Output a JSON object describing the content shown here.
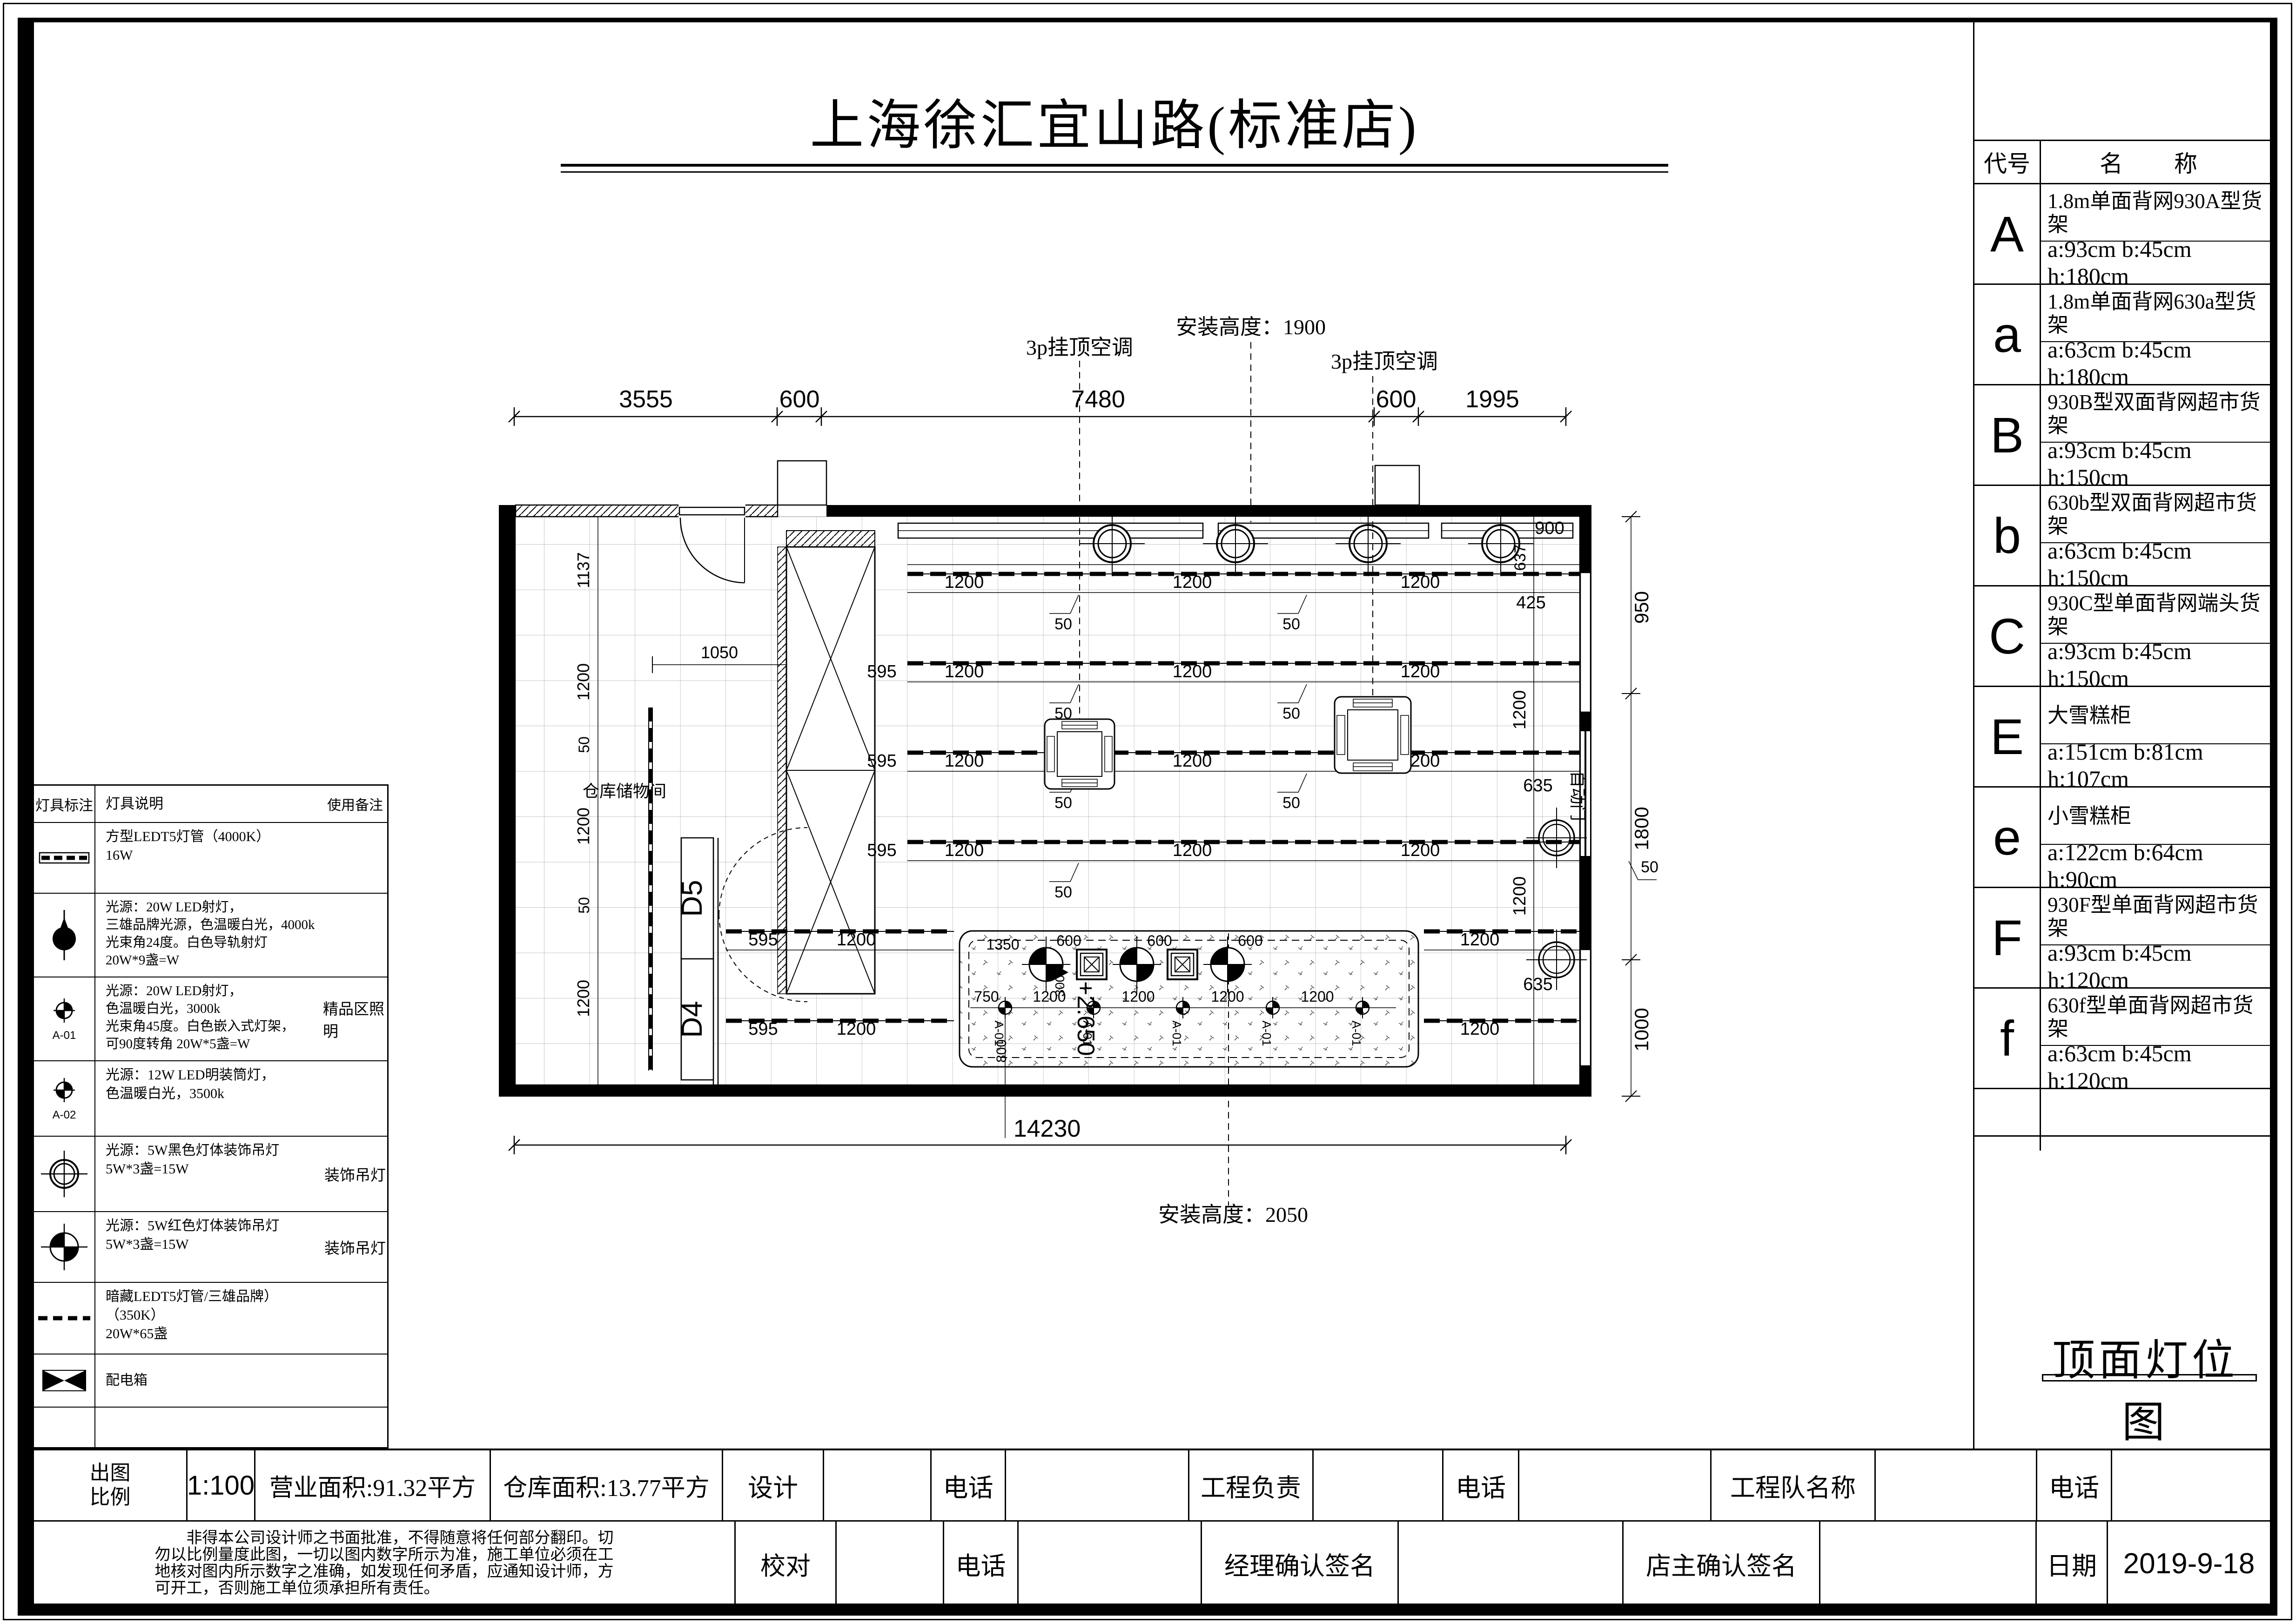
{
  "title": "上海徐汇宜山路(标准店)",
  "drawing_name": "顶面灯位图",
  "shelf_table": {
    "header_code": "代号",
    "header_name": "名　称",
    "rows": [
      {
        "code": "A",
        "name": "1.8m单面背网930A型货架",
        "dims": "a:93cm b:45cm h:180cm"
      },
      {
        "code": "a",
        "name": "1.8m单面背网630a型货架",
        "dims": "a:63cm b:45cm h:180cm"
      },
      {
        "code": "B",
        "name": "930B型双面背网超市货架",
        "dims": "a:93cm b:45cm h:150cm"
      },
      {
        "code": "b",
        "name": "630b型双面背网超市货架",
        "dims": "a:63cm b:45cm h:150cm"
      },
      {
        "code": "C",
        "name": "930C型单面背网端头货架",
        "dims": "a:93cm b:45cm h:150cm"
      },
      {
        "code": "E",
        "name": "大雪糕柜",
        "dims": "a:151cm b:81cm h:107cm"
      },
      {
        "code": "e",
        "name": "小雪糕柜",
        "dims": "a:122cm b:64cm h:90cm"
      },
      {
        "code": "F",
        "name": "930F型单面背网超市货架",
        "dims": "a:93cm b:45cm h:120cm"
      },
      {
        "code": "f",
        "name": "630f型单面背网超市货架",
        "dims": "a:63cm b:45cm h:120cm"
      }
    ]
  },
  "light_legend": {
    "headers": {
      "mark": "灯具标注",
      "desc": "灯具说明",
      "remark": "使用备注"
    },
    "rows": [
      {
        "desc": "方型LEDT5灯管（4000K）\n16W",
        "remark": "",
        "tag": ""
      },
      {
        "desc": "光源：20W LED射灯，\n三雄品牌光源，色温暖白光，4000k\n光束角24度。白色导轨射灯\n20W*9盏=W",
        "remark": "",
        "tag": ""
      },
      {
        "desc": "光源：20W LED射灯，\n色温暖白光，3000k\n光束角45度。白色嵌入式灯架，\n可90度转角 20W*5盏=W",
        "remark": "精品区照明",
        "tag": "A-01"
      },
      {
        "desc": "光源：12W LED明装筒灯，\n色温暖白光，3500k",
        "remark": "",
        "tag": "A-02"
      },
      {
        "desc": "光源：5W黑色灯体装饰吊灯\n5W*3盏=15W",
        "remark": "装饰吊灯",
        "tag": ""
      },
      {
        "desc": "光源：5W红色灯体装饰吊灯\n5W*3盏=15W",
        "remark": "装饰吊灯",
        "tag": ""
      },
      {
        "desc": "暗藏LEDT5灯管/三雄品牌）（350K）\n20W*65盏",
        "remark": "",
        "tag": ""
      },
      {
        "desc": "配电箱",
        "remark": "",
        "tag": ""
      }
    ]
  },
  "plan": {
    "ann": {
      "ac": "3p挂顶空调",
      "h1900": "安装高度：1900",
      "h2050": "安装高度：2050",
      "storage": "仓库储物间",
      "autodoor": "自动门",
      "level": "+2.650",
      "d5": "D5",
      "d4": "D4"
    },
    "labels": {
      "n3555": "3555",
      "n600": "600",
      "n7480": "7480",
      "n1995": "1995",
      "n14230": "14230",
      "n1200": "1200",
      "n50": "50",
      "n595": "595",
      "n637": "637",
      "n425": "425",
      "n635": "635",
      "n900": "900",
      "n950": "950",
      "n1800": "1800",
      "n1000": "1000",
      "n1137": "1137",
      "n1050": "1050",
      "n800": "800",
      "n750": "750",
      "n1350": "1350",
      "n300": "300",
      "a01": "A-01"
    }
  },
  "title_block": {
    "scale_label": "出图\n比例",
    "scale": "1:100",
    "area1": "营业面积:91.32平方",
    "area2": "仓库面积:13.77平方",
    "design": "设计",
    "phone": "电话",
    "lead": "工程负责",
    "team": "工程队名称",
    "check": "校对",
    "manager": "经理确认签名",
    "owner": "店主确认签名",
    "date_label": "日期",
    "date": "2019-9-18",
    "disclaimer": "　　非得本公司设计师之书面批准，不得随意将任何部分翻印。切\n勿以比例量度此图，一切以图内数字所示为准，施工单位必须在工\n地核对图内所示数字之准确，如发现任何矛盾，应通知设计师，方\n可开工，否则施工单位须承担所有责任。"
  }
}
